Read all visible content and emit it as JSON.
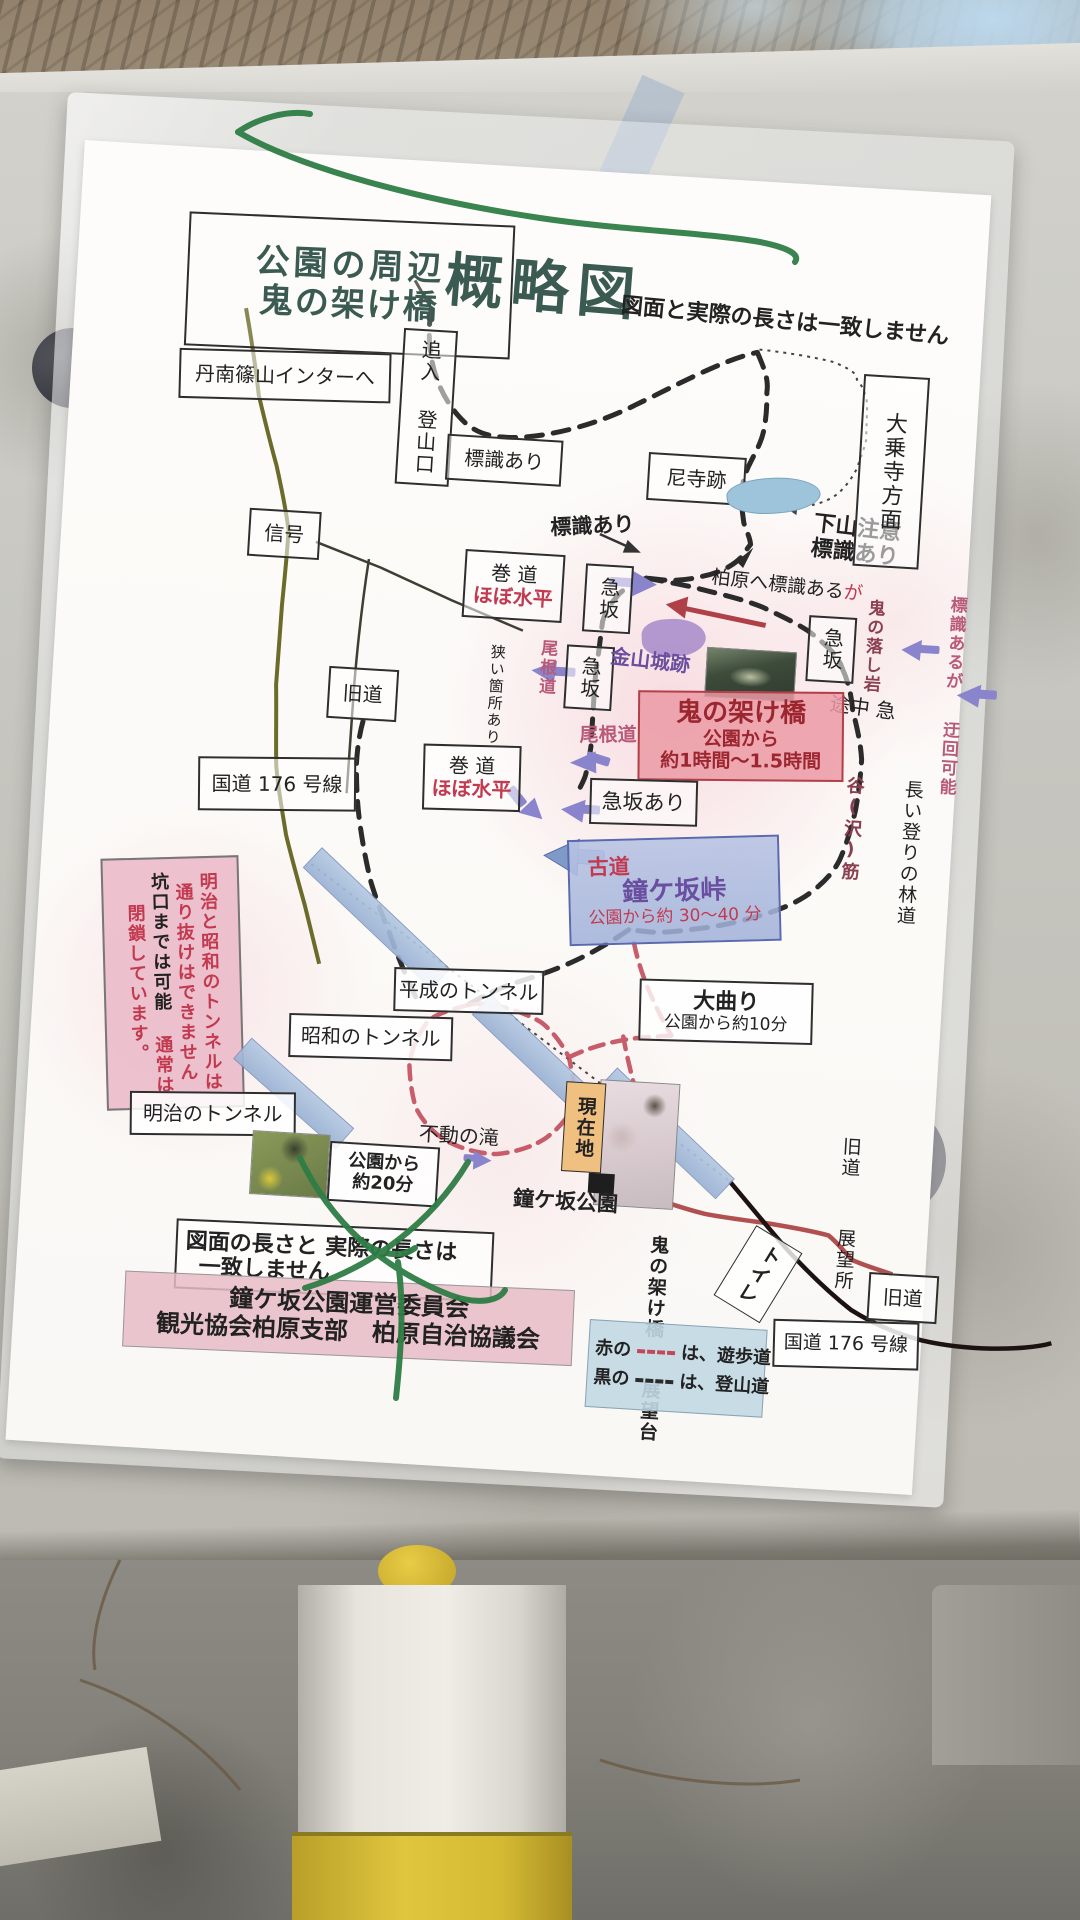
{
  "title": {
    "line1": "公園の周辺",
    "line2": "鬼の架け橋",
    "big": "概略図",
    "subtitle": "図面と実際の長さは一致しません"
  },
  "labels": {
    "tannan": "丹南篠山インターへ",
    "oiire": "追入 登山口",
    "hyoshiki_ari": "標識あり",
    "amadera": "尼寺跡",
    "gezan1": "下山注意",
    "gezan2": "標識あり",
    "daijoji": "大乗寺方面",
    "shingo": "信号",
    "makimichi": "巻 道",
    "hobo_suihei": "ほぼ水平",
    "kyusaka": "急坂",
    "kaibara": "柏原へ標識ある",
    "kaibara_ga": "が",
    "oni_otoshi_iwa": "鬼の落し岩",
    "hyoshiki_aruga": "標識あるが",
    "ukai_kano": "迂回可能",
    "tochu_kyu": "途中 急",
    "kyudo": "旧道",
    "semai": "狭い箇所あり",
    "onemichi": "尾根道",
    "kanayama": "金山城跡",
    "onibashi_title": "鬼の架け橋",
    "onibashi_l2": "公園から",
    "onibashi_l3": "約1時間〜1.5時間",
    "kokudo176": "国道 176 号線",
    "kyusaka_ari": "急坂あり",
    "kodo": "古道",
    "kanegasaka_toge": "鐘ケ坂峠",
    "kodo_time": "公園から約 30〜40 分",
    "tani_suji": "谷(沢)筋",
    "nagai_nobori": "長い登りの林道",
    "warn1": "明治と昭和のトンネルは",
    "warn2": "通り抜けはできません",
    "warn3": "坑口までは可能",
    "warn4": "通常は閉鎖しています。",
    "heisei": "平成のトンネル",
    "omagari": "大曲り",
    "omagari_time": "公園から約10分",
    "showa": "昭和のトンネル",
    "meiji": "明治のトンネル",
    "fudo": "不動の滝",
    "koen_kara": "公園から",
    "yaku20": "約20分",
    "genzaichi": "現在地",
    "kanegasaka_koen": "鐘ケ坂公園",
    "zumen1": "図面の長さと 実際の長さは",
    "zumen2": "一致しません",
    "com1": "鐘ケ坂公園運営委員会",
    "com2": "観光協会柏原支部　柏原自治協議会",
    "tenbosho1": "旧道",
    "tenbosho2": "展望所",
    "tenbodai1": "鬼の架け橋",
    "tenbodai2": "展望台",
    "toilet": "トイレ",
    "legend_red_label": "赤の",
    "legend_red_desc": "は、遊歩道",
    "legend_black_label": "黒の",
    "legend_black_desc": "は、登山道"
  },
  "colors": {
    "red_text": "#c23a50",
    "purple_text": "#6a4fa0",
    "pink_box_bg": "#eb9aa4",
    "blue_box_border": "#5a6ab0",
    "trail_black": "#2b2b2b",
    "walkway_red": "#c04858",
    "road_olive": "#6b6b2a",
    "tunnel_bar_blue": "#a8bede",
    "legend_bg": "#c2d8e4",
    "current_location_bg": "#f0c080"
  }
}
